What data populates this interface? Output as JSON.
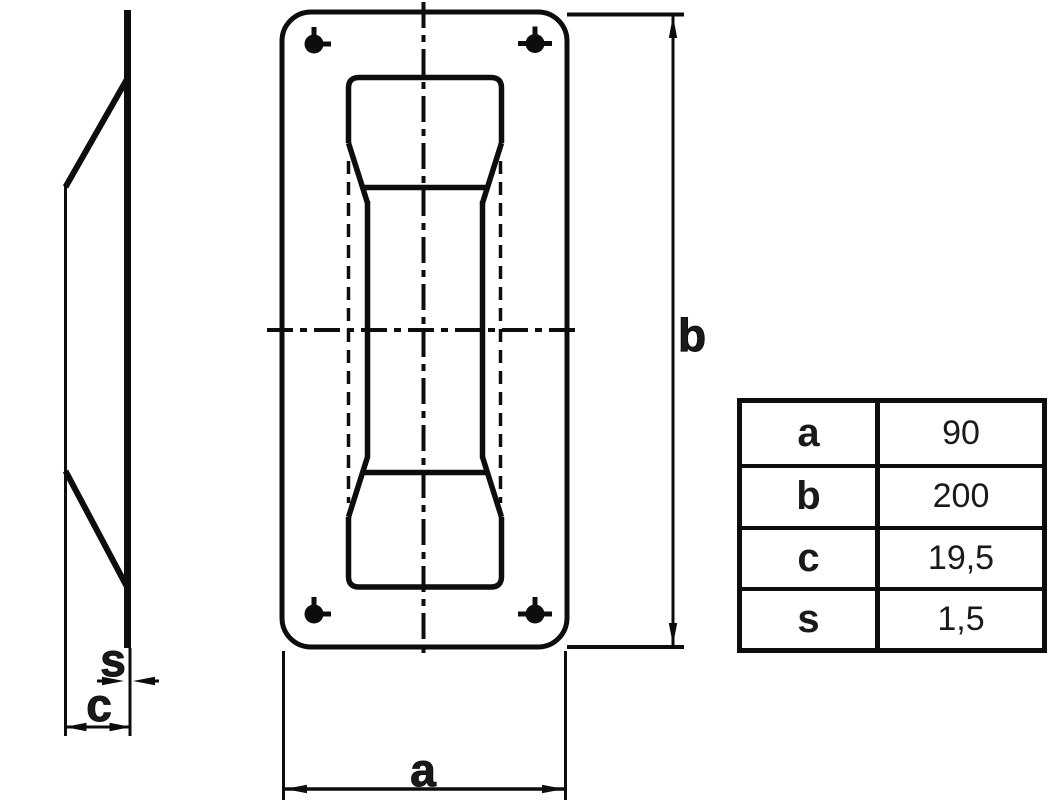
{
  "drawing": {
    "dimension_labels": {
      "width": "a",
      "height": "b",
      "depth": "c",
      "thickness": "s"
    }
  },
  "table": {
    "rows": [
      {
        "param": "a",
        "value": "90"
      },
      {
        "param": "b",
        "value": "200"
      },
      {
        "param": "c",
        "value": "19,5"
      },
      {
        "param": "s",
        "value": "1,5"
      }
    ]
  },
  "colors": {
    "line": "#000000",
    "background": "#ffffff"
  }
}
